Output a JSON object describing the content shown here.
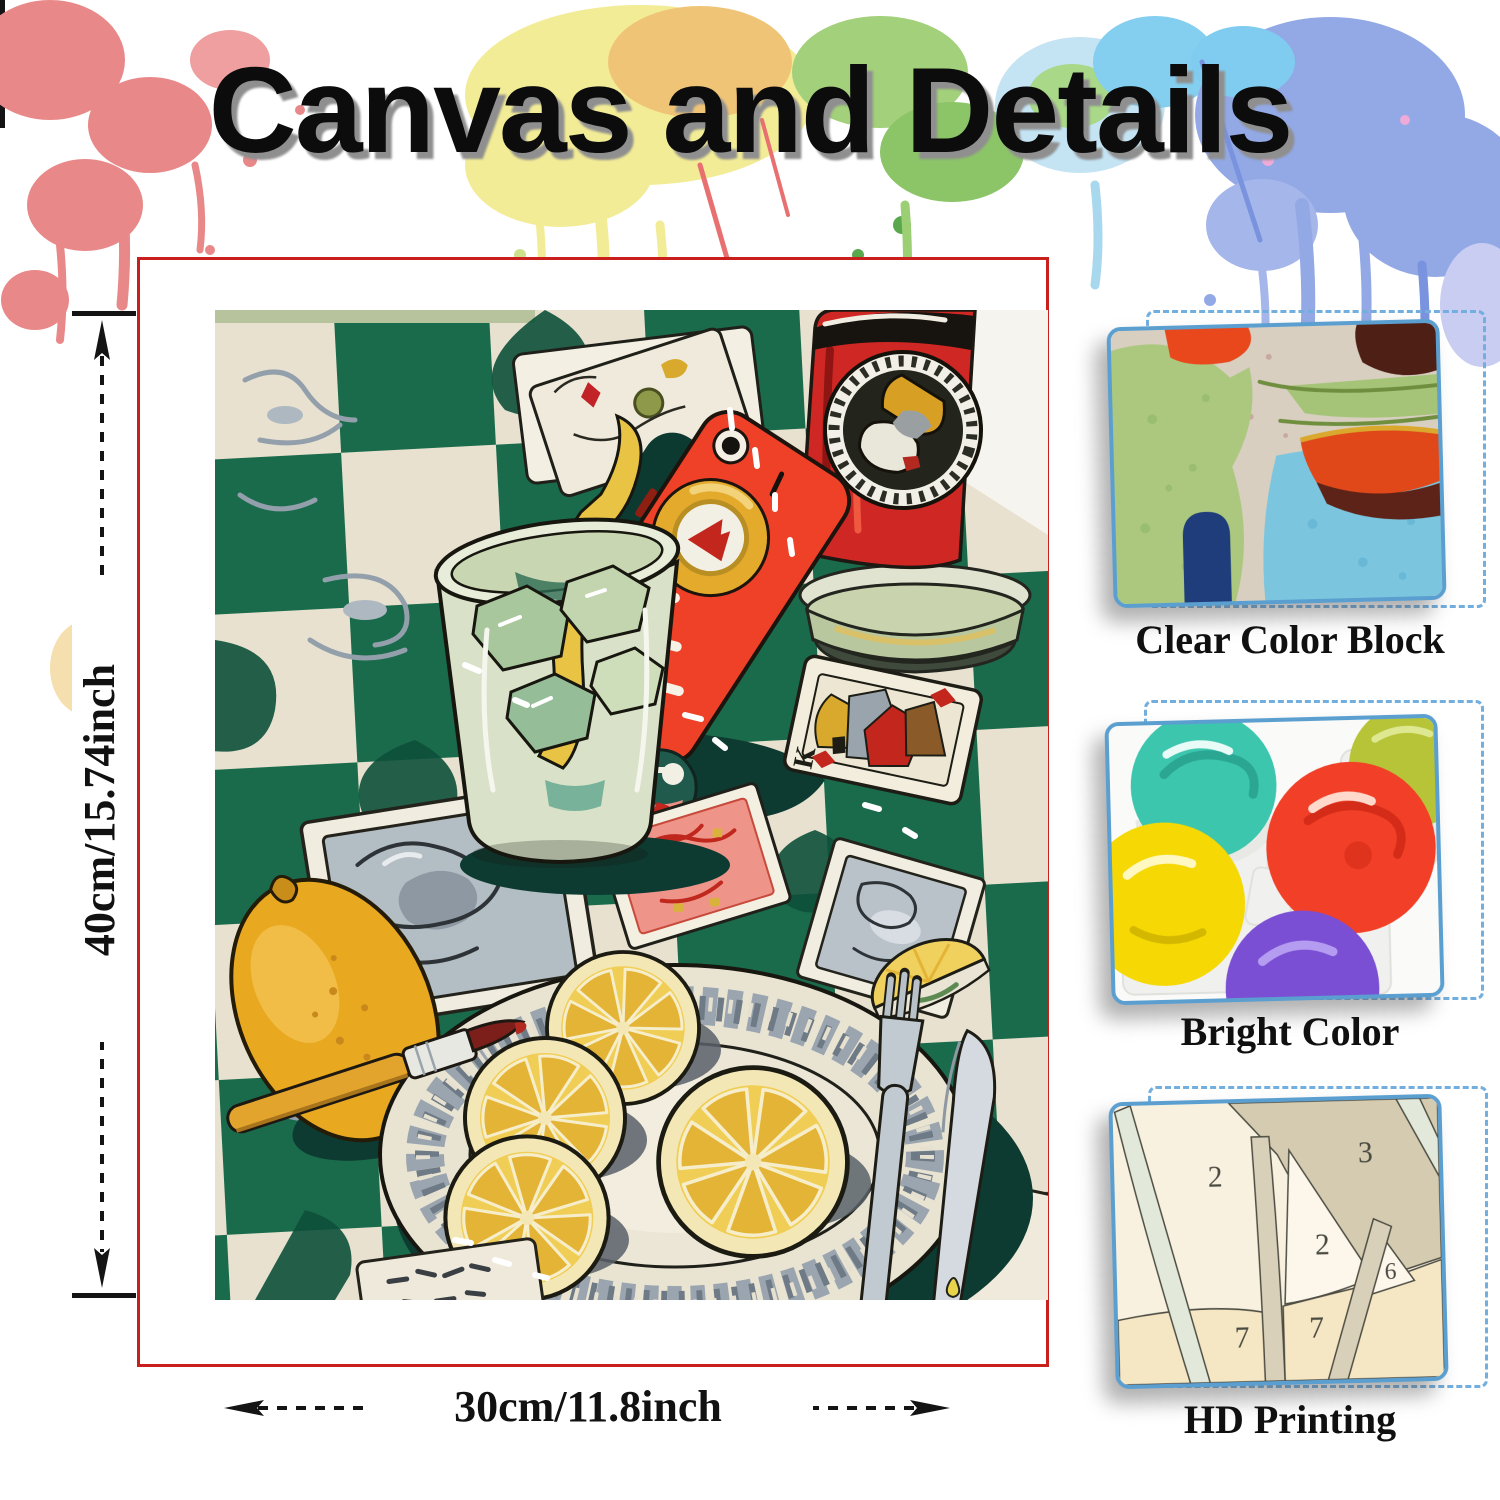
{
  "header": {
    "title": "Canvas and Details"
  },
  "canvas_preview": {
    "height_label": "40cm/15.74inch",
    "width_label": "30cm/11.8inch",
    "card_rank": "K"
  },
  "details": [
    {
      "label": "Clear Color Block"
    },
    {
      "label": "Bright Color"
    },
    {
      "label": "HD Printing"
    }
  ],
  "hd_numbers": [
    "2",
    "3",
    "2",
    "6",
    "7",
    "7"
  ],
  "colors": {
    "frame_red": "#c9201d",
    "thumb_border_blue": "#5b9fd0",
    "dashed_blue": "#72aede",
    "checker_green": "#1a6b4b",
    "phone_red": "#ee4128",
    "lemon_yellow": "#efcd55"
  }
}
